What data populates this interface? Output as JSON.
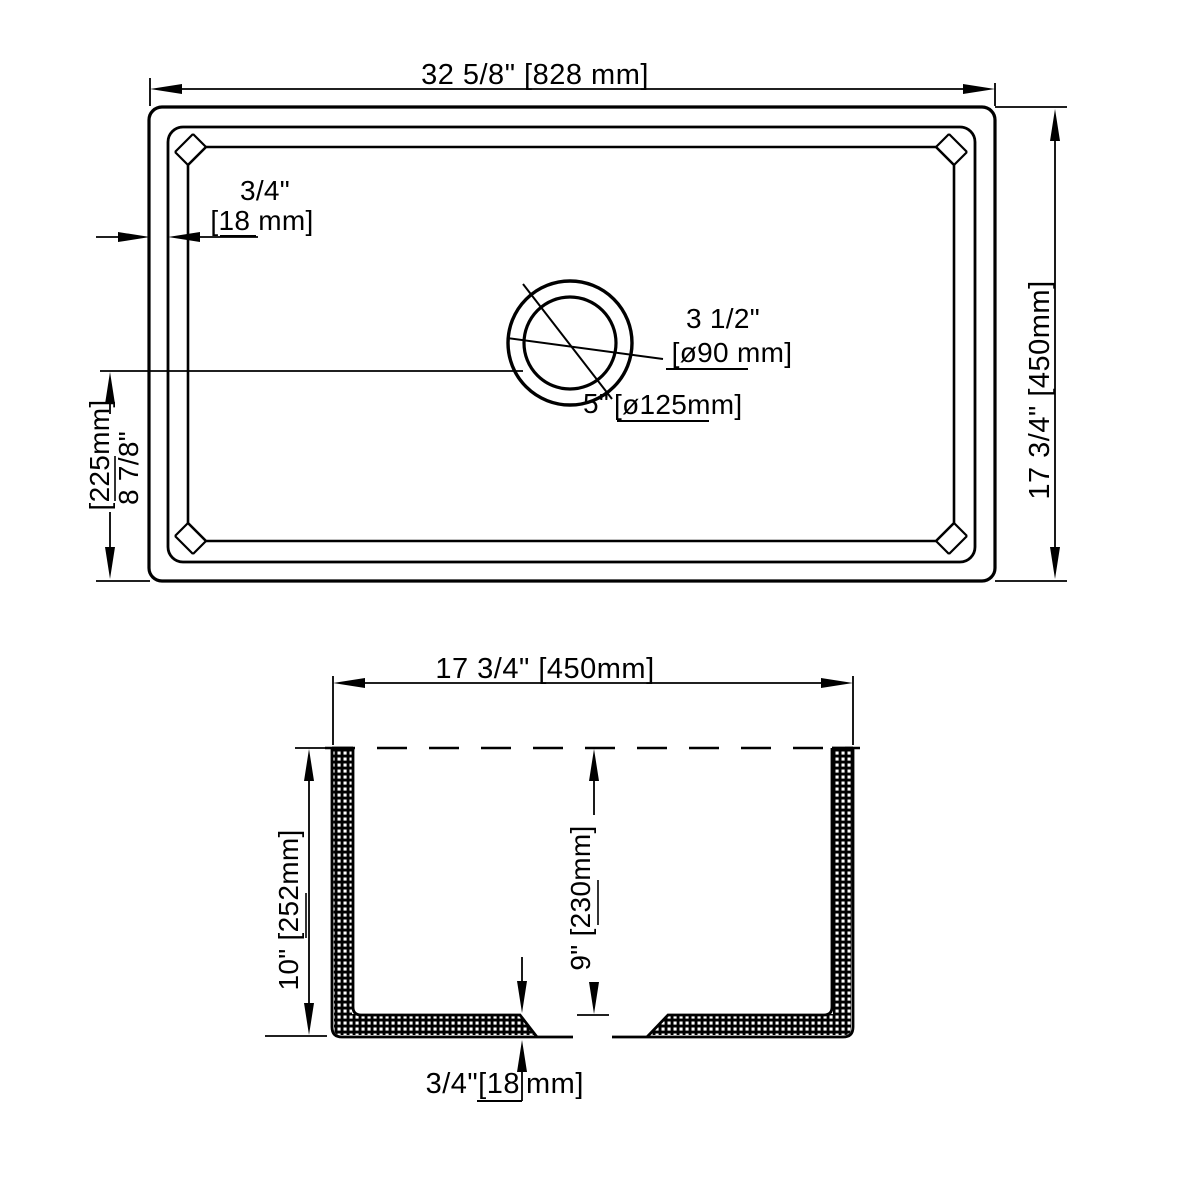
{
  "title": "sink-dimension-drawing",
  "colors": {
    "line": "#000000",
    "background": "#ffffff"
  },
  "plan_view": {
    "width_dim": "32 5/8\" [828 mm]",
    "height_dim": "17 3/4\" [450mm]",
    "rim_dim_in": "3/4\"",
    "rim_dim_mm": "[18 mm]",
    "drain_offset_mm": "[225mm]",
    "drain_offset_in": "8 7/8\"",
    "drain_inner_in": "3 1/2\"",
    "drain_inner_mm": "[ø90 mm]",
    "drain_outer_in": "5\"",
    "drain_outer_mm": "[ø125mm]"
  },
  "section_view": {
    "width_dim": "17 3/4\" [450mm]",
    "outer_height_dim": "10\" [252mm]",
    "inner_depth_dim": "9\" [230mm]",
    "floor_thickness_in": "3/4\"[18",
    "floor_thickness_mm": "mm]"
  }
}
